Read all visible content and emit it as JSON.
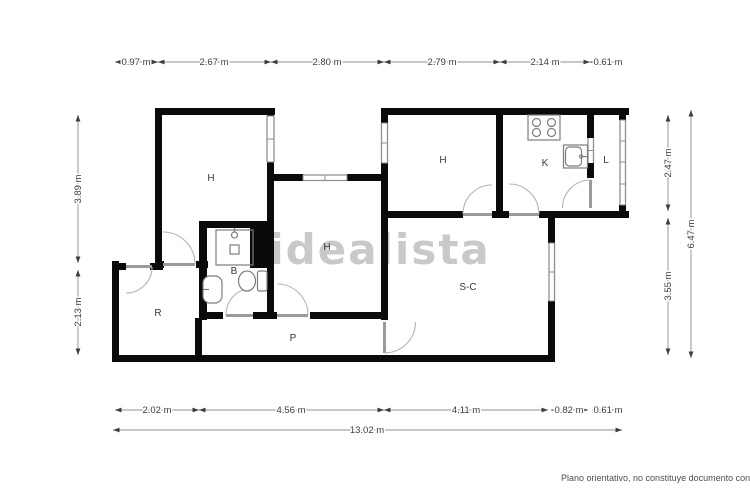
{
  "watermark": "idealista",
  "disclaimer": "Plano orientativo, no constituye documento contractu",
  "rooms": {
    "h1": "H",
    "h2": "H",
    "h3": "H",
    "k": "K",
    "l": "L",
    "b": "B",
    "r": "R",
    "p": "P",
    "sc": "S-C"
  },
  "dims": {
    "top": [
      "0.97 m",
      "2.67 m",
      "2.80 m",
      "2.79 m",
      "2.14 m",
      "0.61 m"
    ],
    "bottom": [
      "2.02 m",
      "4.56 m",
      "4.11 m",
      "0.82 m",
      "0.61 m"
    ],
    "total": "13.02 m",
    "left": [
      "3.89 m",
      "2.13 m"
    ],
    "right": [
      "2.47 m",
      "3.55 m",
      "6.47 m"
    ]
  },
  "colors": {
    "wall": "#0a0a0a",
    "window": "#8f8f8f",
    "door": "#9a9a9a",
    "watermark": "#c9c9c9",
    "dim_text": "#3c3c3c"
  }
}
